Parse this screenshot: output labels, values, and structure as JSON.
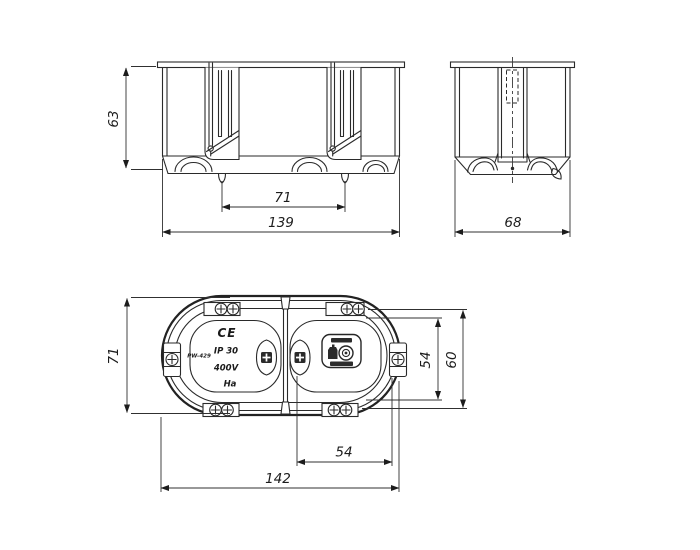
{
  "page": {
    "background": "#ffffff",
    "ink": "#2a2a2a"
  },
  "drawing": {
    "front_view": {
      "dim_height": "63",
      "dim_claw_spacing": "71",
      "dim_width": "139"
    },
    "side_view": {
      "dim_depth": "68"
    },
    "plan_view": {
      "dim_height": "71",
      "dim_screw_spacing_vertical": "54",
      "dim_outer_vertical": "60",
      "dim_screw_spacing_horizontal": "54",
      "dim_length": "142",
      "markings": {
        "ce_mark": "CE",
        "ip_rating": "IP 30",
        "voltage": "400V",
        "material_mark": "Ha",
        "product_code": "PW-429"
      }
    }
  }
}
